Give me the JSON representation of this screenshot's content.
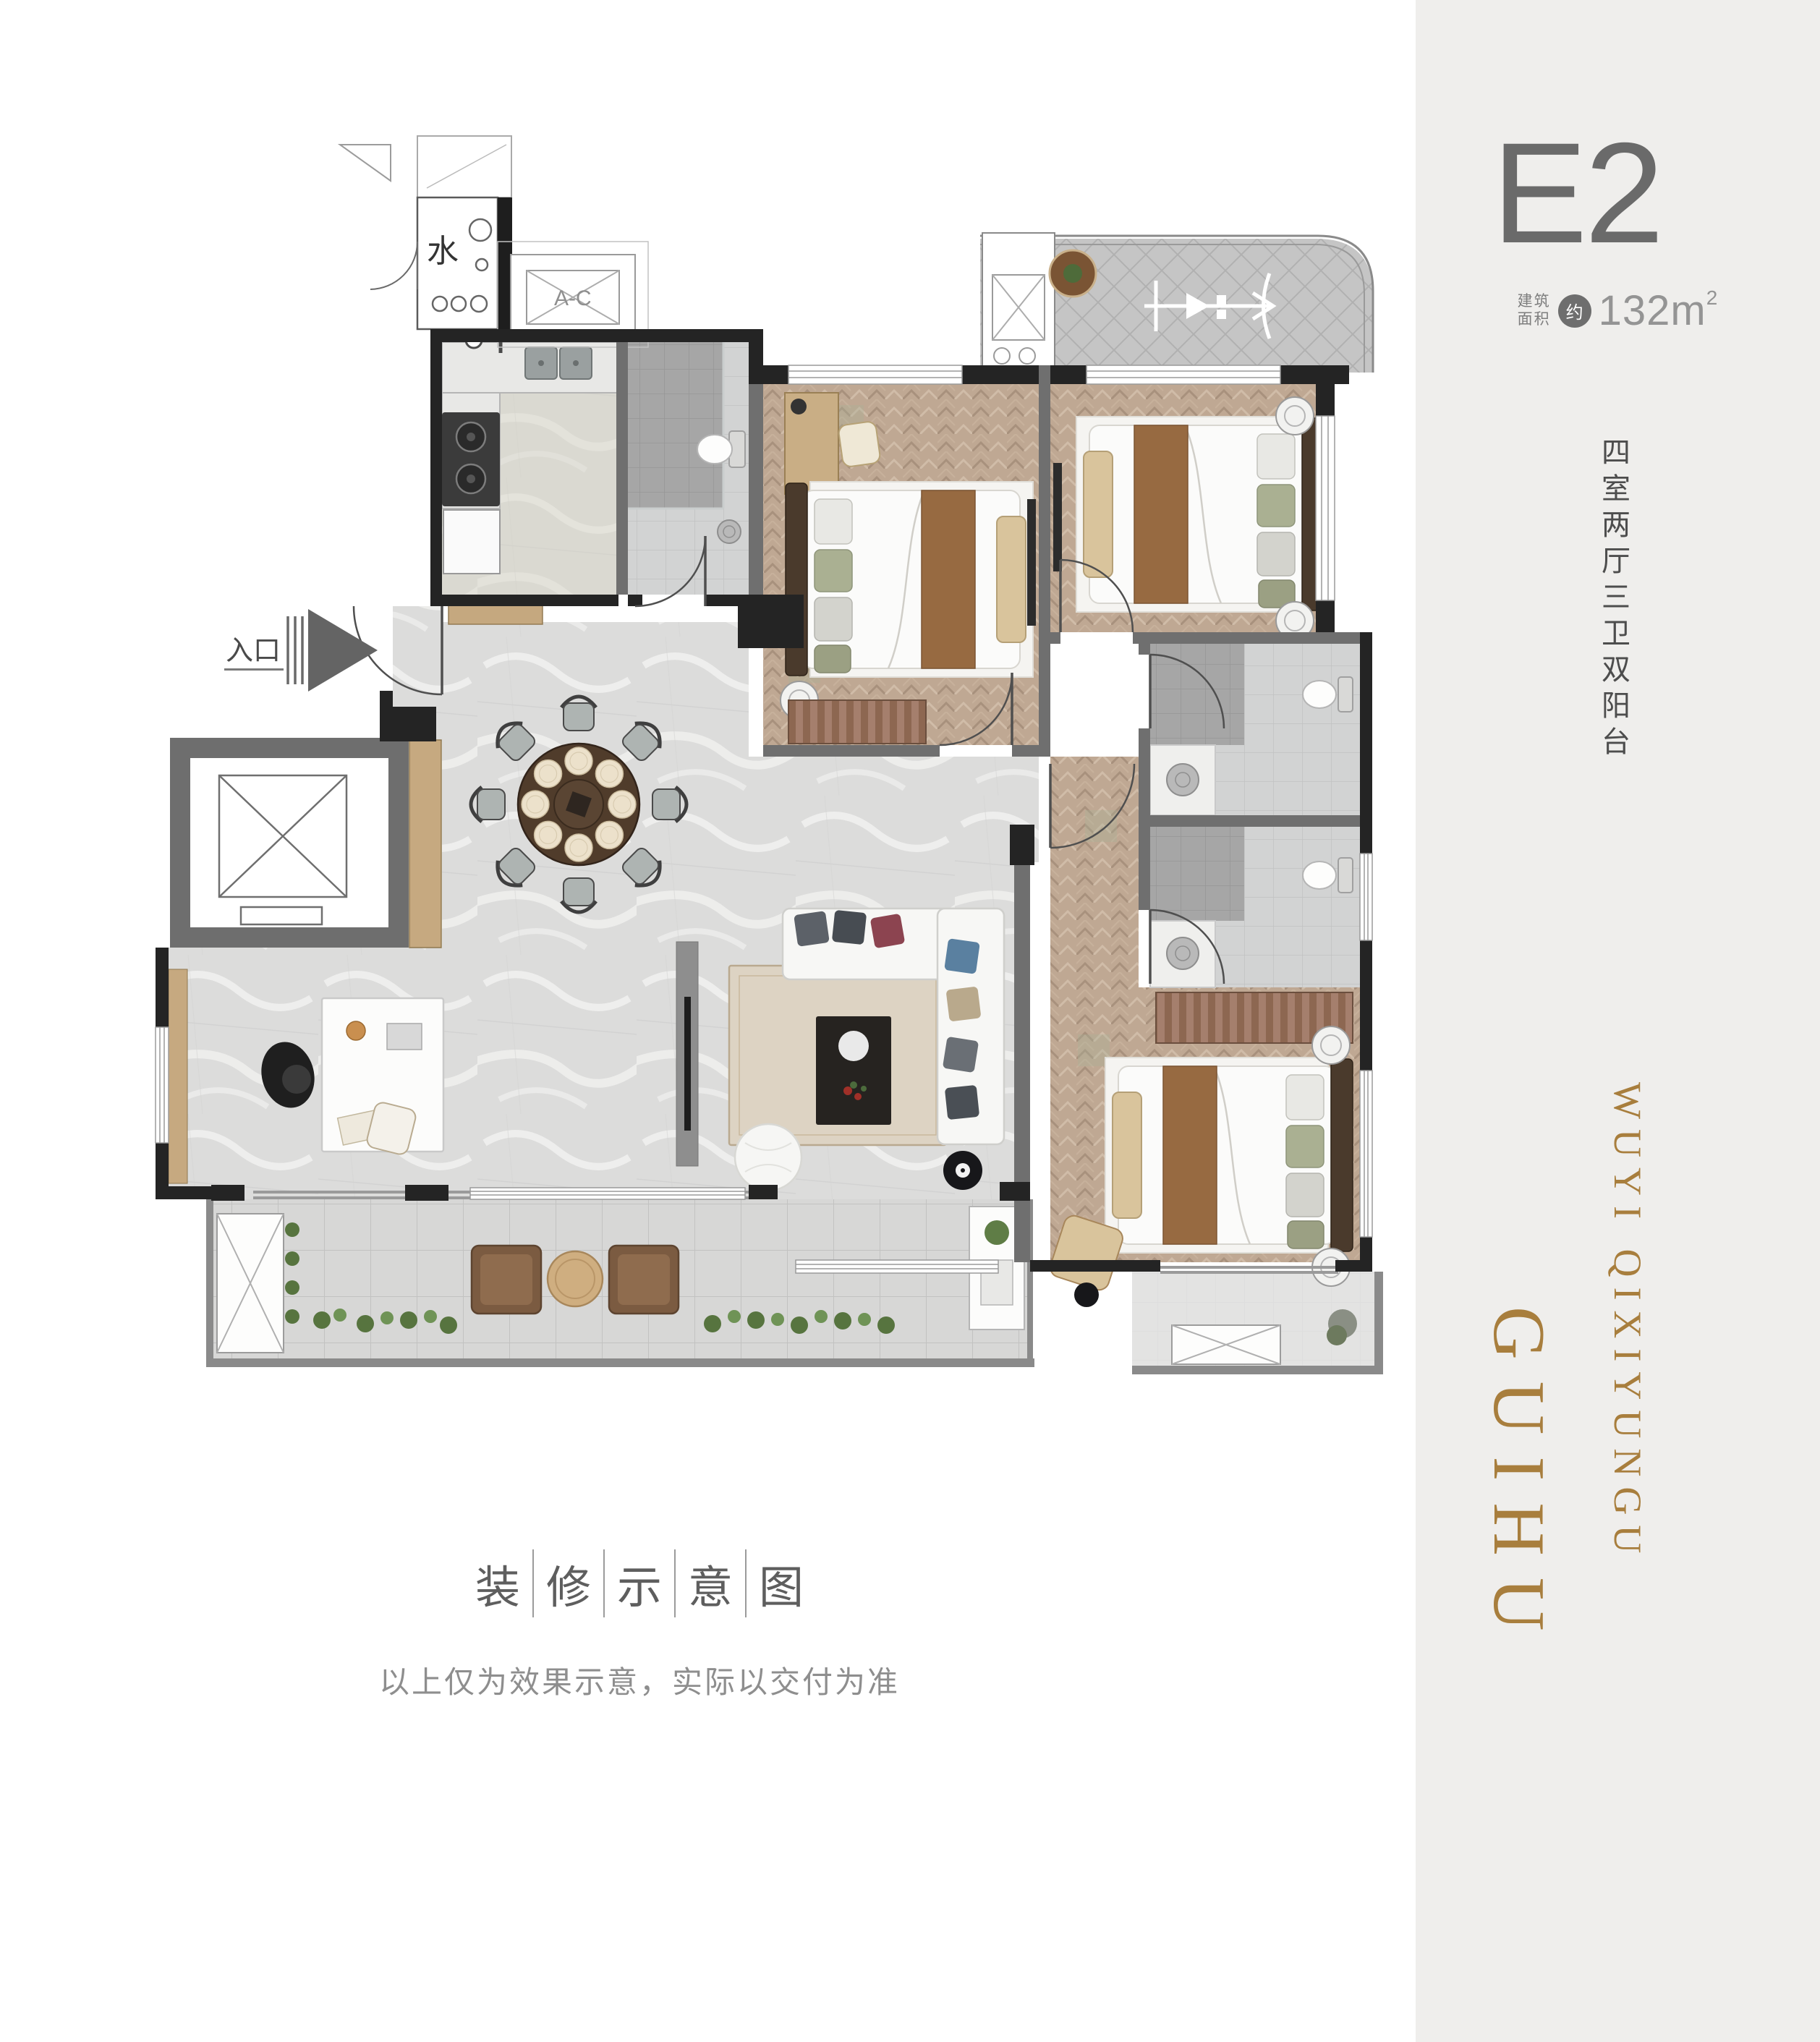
{
  "page": {
    "background": "#ffffff"
  },
  "sidebar": {
    "background": "#efeeec",
    "plan_code": "E2",
    "area_label_line1": "建筑",
    "area_label_line2": "面积",
    "area_circle": "约",
    "area_value": "132m",
    "area_exponent": "2",
    "layout_text": "四室两厅三卫双阳台",
    "brand_small": "WUYI QIXIYUNGU",
    "brand_large": "GUIHU",
    "accent_gold": "#a87e3d",
    "code_color": "#6a6a6a"
  },
  "caption": {
    "title_chars": [
      "装",
      "修",
      "示",
      "意",
      "图"
    ],
    "disclaimer": "以上仅为效果示意，实际以交付为准"
  },
  "plan_labels": {
    "entrance": "入口",
    "water": "水",
    "ac": "A-C"
  }
}
